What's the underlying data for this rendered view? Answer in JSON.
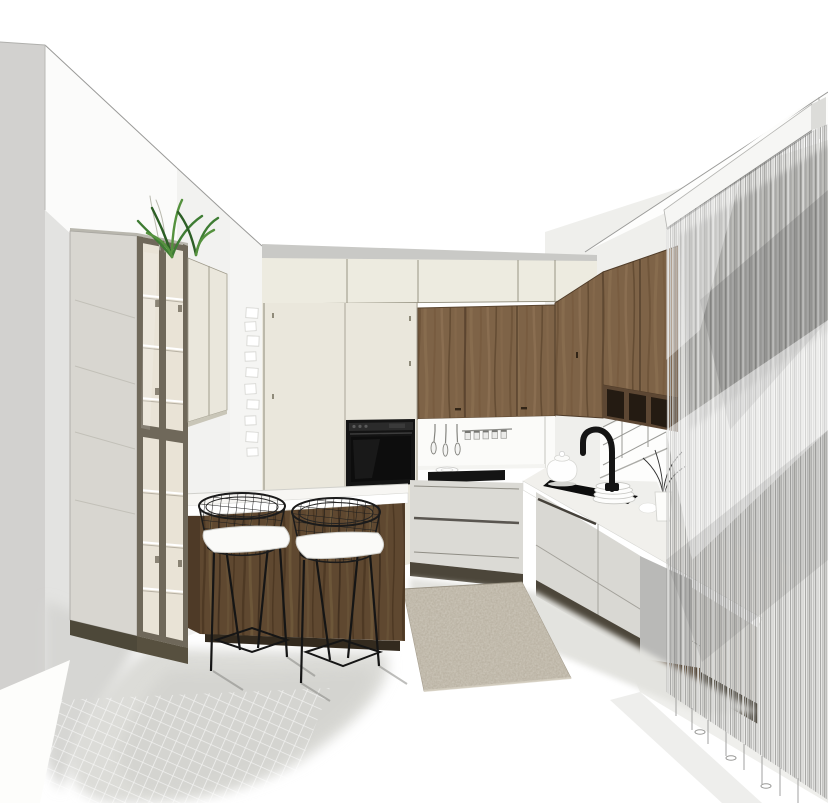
{
  "scene": {
    "type": "3d-interior-render",
    "room": "kitchen",
    "description": "Perspective render of an L-shaped kitchen: tall glass-front display cabinet on the left wall, walnut island with white countertop and two black wire barstools with white seat pads, cream tall cabinets with built-in black oven, walnut upper cabinets over a white backsplash with hanging utensils, black induction hob, right-hand run with black sink, black gooseneck faucet, stacked white plates and a vase of branches by a window, walnut wall cabinets with open cubbies on the right wall, floor-to-ceiling string curtain on the right, beige rug on a white floor, potted green plant on top of the cabinets, small white cards pinned to the back-left wall.",
    "objects": [
      "left-wall",
      "glass-display-cabinet",
      "wall-cabinet-cream",
      "plant",
      "pinned-cards",
      "ceiling-bulkhead",
      "cream-tall-cabinets",
      "built-in-oven",
      "walnut-upper-cabinets",
      "backsplash-utensils",
      "spice-rail",
      "induction-hob",
      "plate",
      "base-drawers",
      "island",
      "barstool",
      "barstool",
      "right-counter",
      "sink",
      "faucet",
      "teapot",
      "plate-stack",
      "vase-branches",
      "window",
      "walnut-right-cabinets",
      "open-cubbies",
      "string-curtain",
      "curtain-pelmet",
      "rug",
      "floor-shadows"
    ]
  },
  "colors": {
    "wall_side": "#d2d1cf",
    "wall_bright": "#fbfbfa",
    "wall_low": "#e3e3e1",
    "wall_back": "#f5f5f3",
    "wall_right_backdrop": "#efefec",
    "bulkhead": "#c9c9c6",
    "cream": "#eae7dc",
    "cream_top_row": "#edebe0",
    "olive_frame": "#6f685a",
    "glass_side": "#d8d6d0",
    "glass_interior": "#e9e3d6",
    "wood_walnut": "#7e6347",
    "wood_island": "#5f4830",
    "cubby_dark": "#241b12",
    "counter_white": "#ffffff",
    "appliance_black": "#141414",
    "plinth_dark": "#4c463a",
    "floor_shadow": "#dcdcd8",
    "rug_beige": "#b4ac9c",
    "curtain_string": "#b5b5b3",
    "pelmet_white": "#f6f6f4",
    "plant_green": "#3f7d33"
  }
}
